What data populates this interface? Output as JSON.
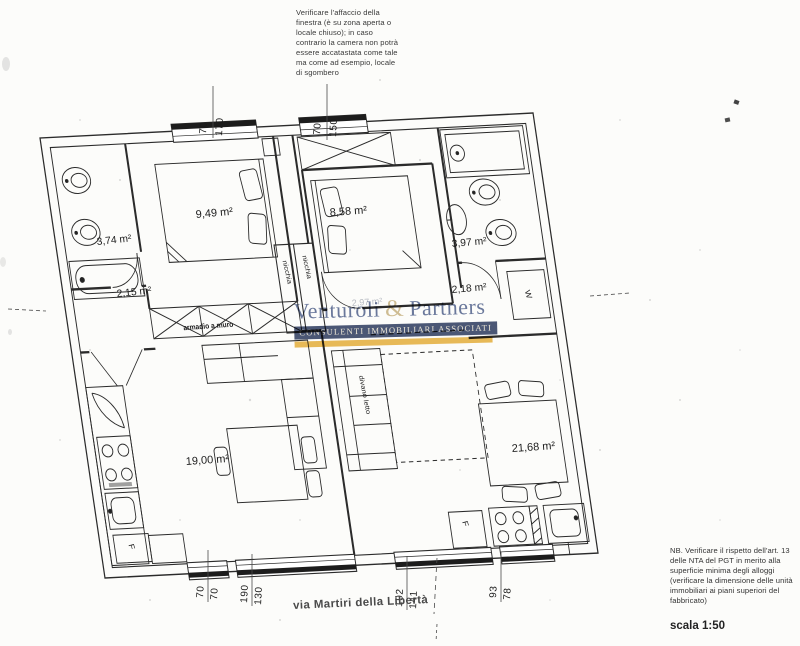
{
  "notes": {
    "window_warning": "Verificare l'affaccio della finestra (è su zona aperta o locale chiuso); in caso contrario la camera non potrà essere accatastata come tale ma come ad esempio, locale di sgombero",
    "nb": "NB. Verificare il rispetto dell'art. 13 delle NTA del PGT in merito alla superficie minima degli alloggi (verificare la dimensione delle unità immobiliari ai piani superiori del fabbricato)",
    "scale": "scala 1:50",
    "street": "via Martiri della Libertà"
  },
  "logo": {
    "name": "Venturoli",
    "ampersand": "&",
    "name2": "Partners",
    "tagline": "CONSULENTI IMMOBILIARI ASSOCIATI",
    "colors": {
      "text": "#5e6e96",
      "ampersand": "#cdb98c",
      "band": "#3d4a6b",
      "band_text": "#efe9d9",
      "underline": "#e9b54b"
    }
  },
  "rooms": {
    "left_bathroom": "3,74 m²",
    "left_bedroom": "9,49 m²",
    "left_hall": "2,15 m²",
    "left_living": "19,00 m²",
    "right_bedroom": "8,58 m²",
    "right_bathroom": "3,97 m²",
    "right_laundry": "2,18 m²",
    "right_living": "21,68 m²",
    "right_hall_faint": "2,97 m²"
  },
  "labels": {
    "wardrobe": "armadio a muro",
    "niche": "nicchia",
    "sofa_bed": "divano letto",
    "washing_machine": "W",
    "fridge": "F"
  },
  "dimensions": {
    "top": [
      [
        "70",
        "170"
      ],
      [
        "70",
        "150"
      ]
    ],
    "bottom": [
      [
        "70",
        "70"
      ],
      [
        "190",
        "130"
      ],
      [
        "192",
        "141"
      ],
      [
        "93",
        "78"
      ]
    ]
  }
}
